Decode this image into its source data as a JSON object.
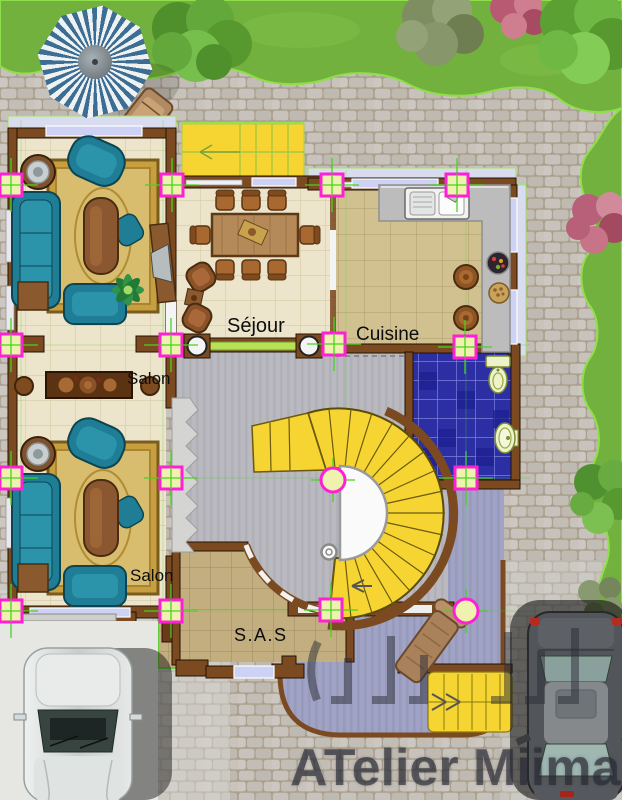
{
  "document": {
    "type": "architectural ground-floor plan rendering",
    "labels": {
      "salon_upper": "Salon",
      "salon_lower": "Salon",
      "sejour": "Séjour",
      "cuisine": "Cuisine",
      "sas": "S.A.S"
    },
    "watermark": {
      "studio": "ATelier Miimary"
    }
  },
  "scene": {
    "items": [
      "parasol",
      "parasol-chair",
      "spiral-staircase",
      "exterior-stairs-top",
      "exterior-stairs-bottom",
      "terrace-bench",
      "white-car",
      "dark-car",
      "garden-trees",
      "grid-markers"
    ]
  },
  "palette": {
    "grass": "#72b13d",
    "grass_edge": "#8fdf4a",
    "pavers": "#c6c2ba",
    "wall_brown": "#7b4a20",
    "floor_cream": "#ece4cb",
    "floor_kitchen": "#d2c190",
    "floor_sas": "#c3ae80",
    "bathroom_blue": "#2c2fa4",
    "hall_gray": "#b9b9bf",
    "terrace_violet": "#a0a3c5",
    "stairs_yellow": "#f6d431",
    "marker_magenta": "#ff20d6",
    "grid_green": "#45d41f",
    "window_lavender": "#cdd2f4",
    "sofa_teal": "#1f7e95",
    "rug_gold": "#c79f3e",
    "umbrella_blue": "#3e6d94"
  }
}
